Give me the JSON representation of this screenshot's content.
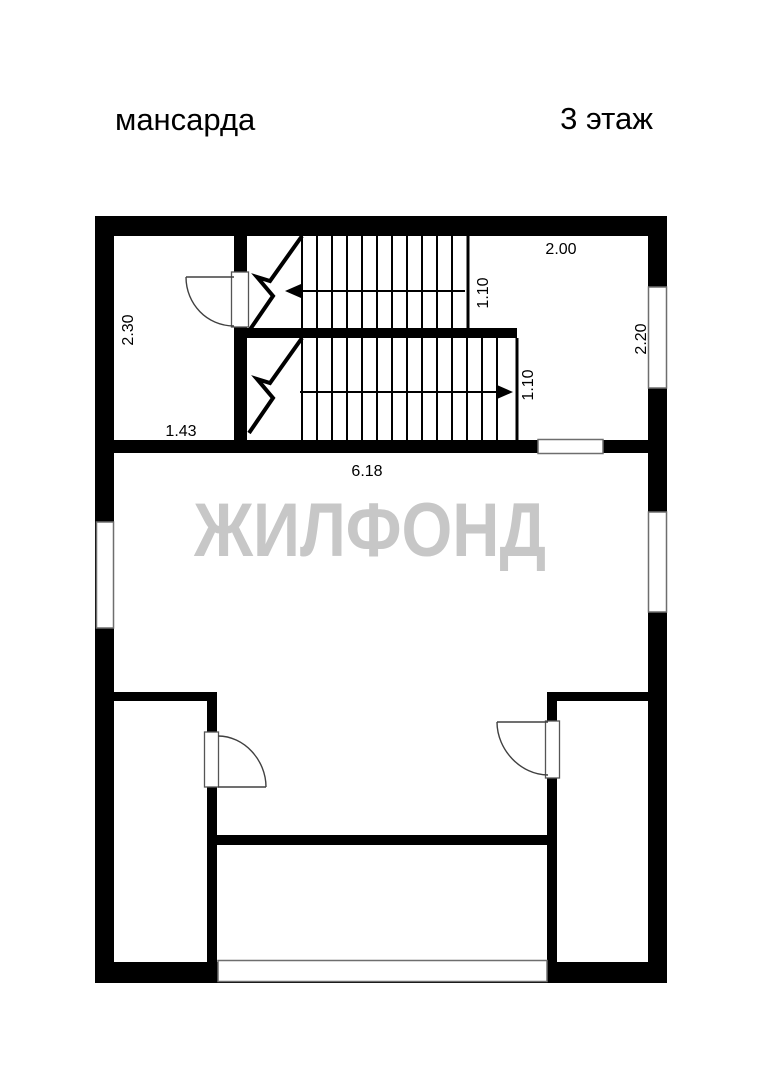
{
  "page": {
    "floor_label_left": "мансарда",
    "floor_label_right": "3 этаж",
    "watermark": "ЖИЛФОНД",
    "colors": {
      "background": "#ffffff",
      "wall": "#000000",
      "watermark": "#c7c7c7",
      "window_outline": "#6e6e6e"
    }
  },
  "dimensions": {
    "stair_landing_width": "2.00",
    "upper_flight_width": "1.10",
    "lower_flight_width": "1.10",
    "right_wall_section": "2.20",
    "top_left_room_depth": "2.30",
    "top_left_room_width": "1.43",
    "main_room_width": "6.18"
  }
}
